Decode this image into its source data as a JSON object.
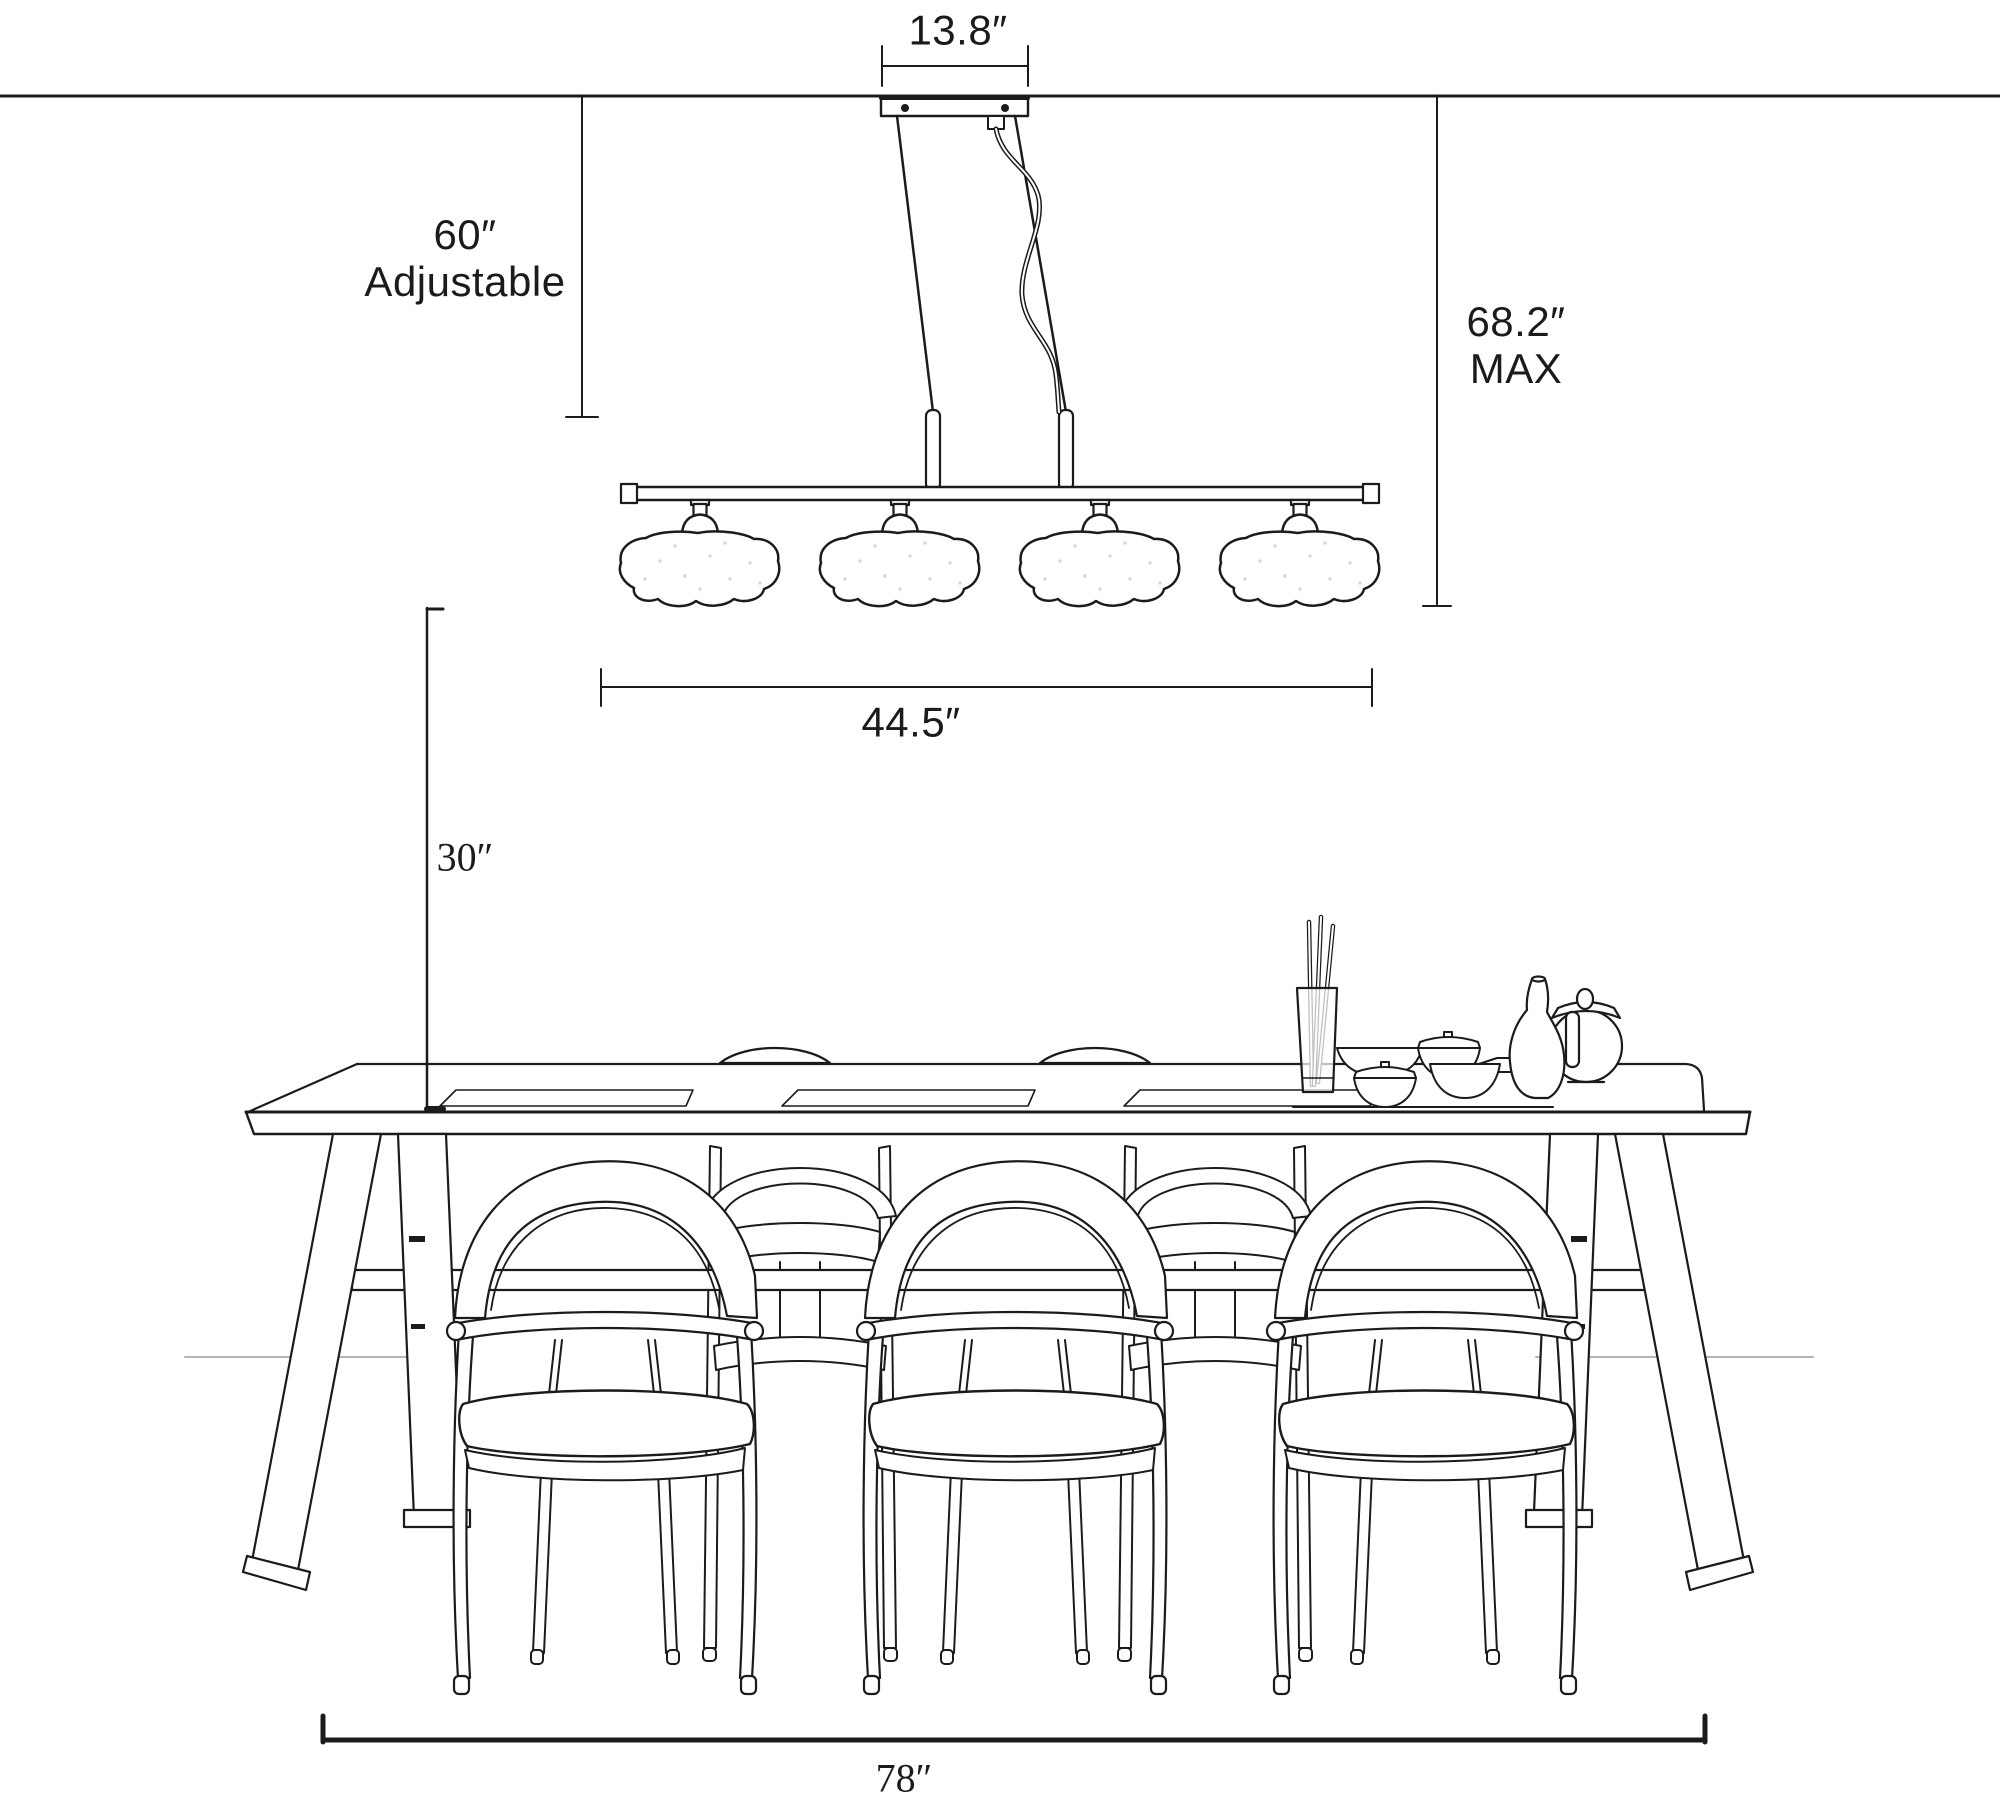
{
  "page": {
    "background": "#ffffff",
    "ink": "#1b1b1b",
    "faint_line": "#b5b5b5",
    "speckle": "#d9d9d9"
  },
  "fixture": {
    "name": "linear-cloud-pendant-light",
    "shade_count": 4,
    "canopy_screws": 2
  },
  "dimensions": {
    "canopy_width": {
      "label": "13.8″",
      "value": 13.8,
      "unit": "in"
    },
    "suspension": {
      "line1": "60″",
      "line2": "Adjustable",
      "value": 60,
      "unit": "in"
    },
    "max_drop": {
      "line1": "68.2″",
      "line2": "MAX",
      "value": 68.2,
      "unit": "in"
    },
    "fixture_length": {
      "label": "44.5″",
      "value": 44.5,
      "unit": "in"
    },
    "fixture_to_table": {
      "label": "30″",
      "value": 30,
      "unit": "in"
    },
    "table_length": {
      "label": "78″",
      "value": 78,
      "unit": "in"
    }
  },
  "scene": {
    "table": "trestle-dining-table",
    "chairs_front": 3,
    "chairs_back_partial": 2,
    "tableware": [
      "chopstick-cup",
      "bowls",
      "lidded-bowls",
      "plate",
      "carafe",
      "teapot"
    ]
  }
}
